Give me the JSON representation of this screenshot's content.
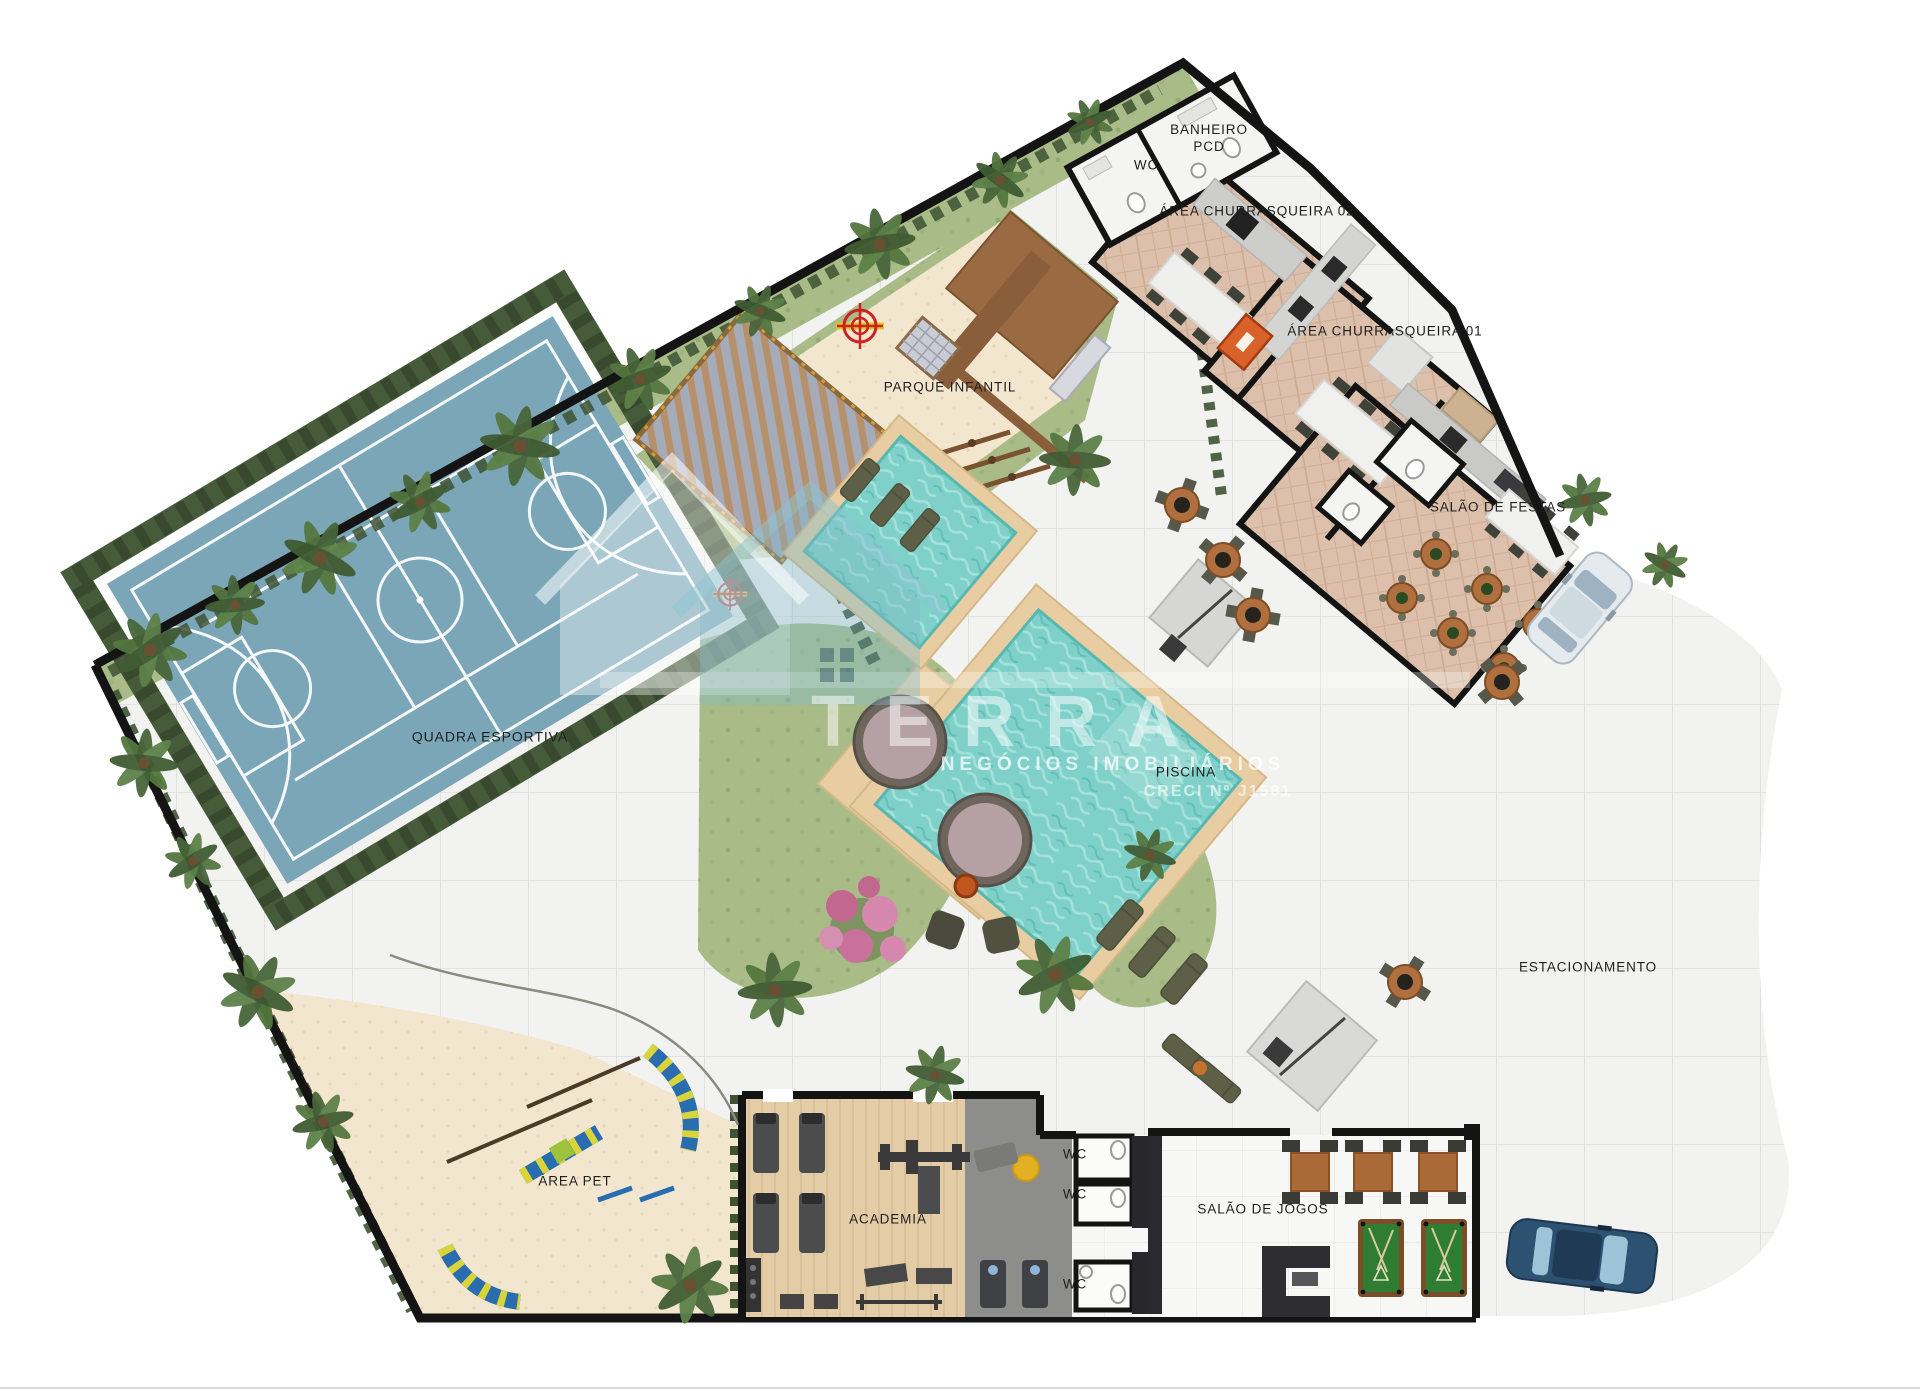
{
  "labels": {
    "wc_top": "WC",
    "banheiro_pcd": "BANHEIRO PCD",
    "churrasqueira_02": "ÁREA CHURRASQUEIRA 02",
    "churrasqueira_01": "ÁREA CHURRASQUEIRA 01",
    "salao_de_festas": "SALÃO DE FESTAS",
    "parque_infantil": "PARQUE INFANTIL",
    "quadra_esportiva": "QUADRA ESPORTIVA",
    "piscina": "PISCINA",
    "estacionamento": "ESTACIONAMENTO",
    "area_pet": "ÁREA PET",
    "academia": "ACADEMIA",
    "wc_gym_1": "WC",
    "wc_gym_2": "WC",
    "wc_gym_3": "WC",
    "salao_de_jogos": "SALÃO DE JOGOS"
  },
  "watermark": {
    "brand": "TERRA",
    "subtitle": "NEGÓCIOS IMOBILIÁRIOS",
    "creci": "CRECI Nº J1581"
  },
  "palette": {
    "court_blue": "#7aa6b8",
    "pool_water": "#7fd0c9",
    "sand": "#f3e6cf",
    "grass": "#a9bc87",
    "hedge_green": "#46593a",
    "wood_floor": "#dcc0ab",
    "gym_wood": "#e4cda6",
    "deck_tan": "#e7cda1",
    "wall_black": "#141414",
    "billiard_green": "#2e7d32",
    "accent_orange": "#d9622b",
    "label_color": "#1f1f1f"
  }
}
